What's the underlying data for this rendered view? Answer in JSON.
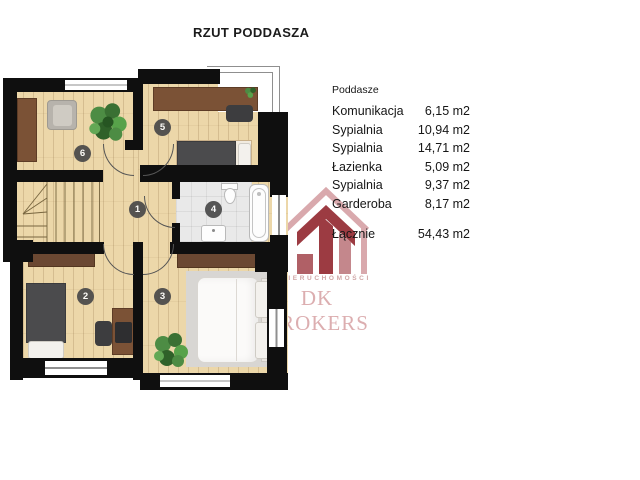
{
  "title": "RZUT PODDASZA",
  "legend": {
    "header": "Poddasze",
    "rows": [
      {
        "label": "Komunikacja",
        "value": "6,15 m2"
      },
      {
        "label": "Sypialnia",
        "value": "10,94 m2"
      },
      {
        "label": "Sypialnia",
        "value": "14,71 m2"
      },
      {
        "label": "Łazienka",
        "value": "5,09 m2"
      },
      {
        "label": "Sypialnia",
        "value": "9,37 m2"
      },
      {
        "label": "Garderoba",
        "value": "8,17 m2"
      }
    ],
    "total": {
      "label": "Łącznie",
      "value": "54,43 m2"
    }
  },
  "plan": {
    "rooms": [
      {
        "number": "1"
      },
      {
        "number": "2"
      },
      {
        "number": "3"
      },
      {
        "number": "4"
      },
      {
        "number": "5"
      },
      {
        "number": "6"
      }
    ]
  },
  "watermark": {
    "line1": "NIERUCHOMOŚCI",
    "line2": "DK BROKERS"
  },
  "colors": {
    "wall": "#0f0f0f",
    "wood": "#ecd7a9",
    "tile": "#e9e9e9",
    "brand_dark": "#9c3b42",
    "brand_light": "#dcaeb0"
  }
}
